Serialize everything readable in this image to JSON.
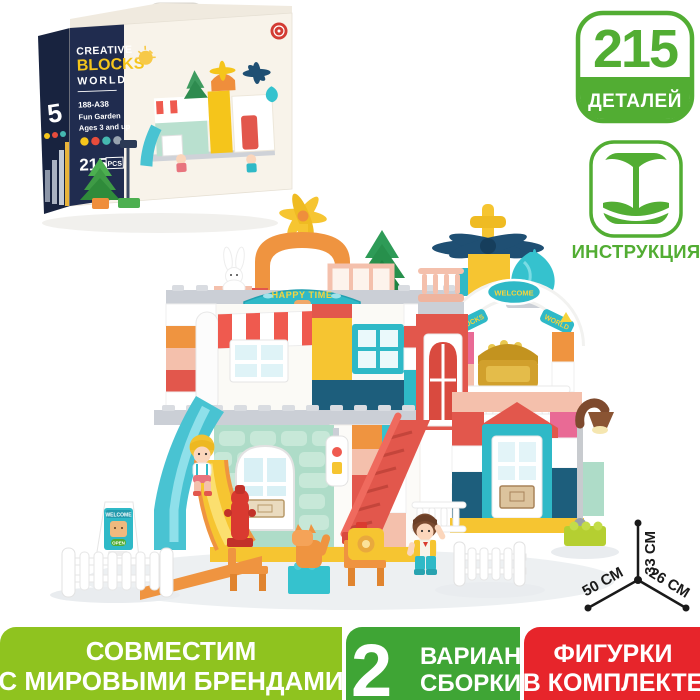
{
  "theme": {
    "accent_green": "#52AD33",
    "banner_light_green": "#8FC31F",
    "banner_green": "#3FA535",
    "banner_red": "#E7252B"
  },
  "box": {
    "title_line1": "CREATIVE",
    "title_line2": "BLOCKS",
    "title_line3": "WORLD",
    "model": "188-A38",
    "theme_name": "Fun Garden",
    "ages": "Ages 3 and up",
    "pieces_value": "215",
    "pieces_unit": "PCS",
    "side_number": "5"
  },
  "badges": {
    "parts": {
      "value": "215",
      "label": "ДЕТАЛЕЙ"
    },
    "instruction": {
      "label": "ИНСТРУКЦИЯ",
      "icon": "open-book-icon"
    }
  },
  "house": {
    "sign_happy_time": "HAPPY TIME",
    "arch_left": "BLOCKS",
    "arch_center": "WELCOME",
    "arch_right": "WORLD",
    "board_title": "WELCOME",
    "board_status": "OPEN"
  },
  "dimensions": {
    "width": "50 СМ",
    "height": "33 СМ",
    "depth": "26 СМ"
  },
  "banners": [
    {
      "line1": "СОВМЕСТИМ",
      "line2": "С МИРОВЫМИ БРЕНДАМИ"
    },
    {
      "number": "2",
      "line1": "ВАРИАНТА",
      "line2": "СБОРКИ"
    },
    {
      "line1": "ФИГУРКИ",
      "line2": "В КОМПЛЕКТЕ"
    }
  ]
}
